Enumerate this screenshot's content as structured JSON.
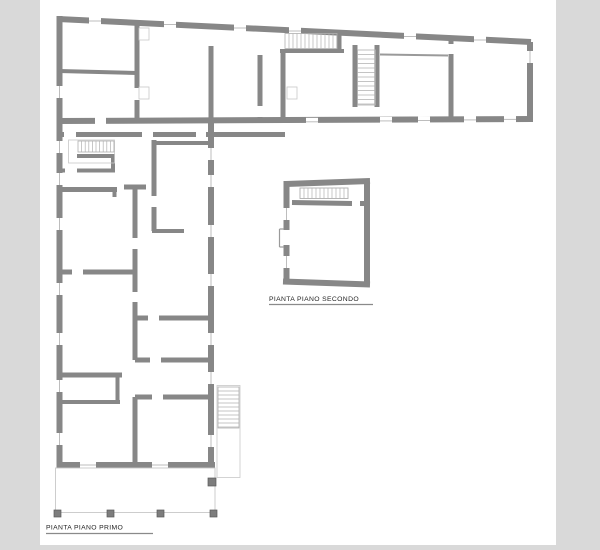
{
  "document": {
    "type": "architectural-floor-plan-sheet",
    "background_color": "#d9d9d9",
    "canvas_color": "#ffffff",
    "canvas": {
      "x": 40,
      "y": 0,
      "width": 516,
      "height": 545
    }
  },
  "colors": {
    "wall": "#878787",
    "thin_wall": "#9a9a9a",
    "window_line": "#bdbdbd",
    "stair_line": "#b0b0b0",
    "outline": "#c8c8c8",
    "pillar_fill": "#7d7d7d",
    "pillar_stroke": "#5a5a5a",
    "underline": "#8a8a8a",
    "text": "#1f1f1f"
  },
  "labels": {
    "floor1": {
      "text": "PIANTA PIANO PRIMO",
      "x": 46,
      "y": 529.5,
      "underline": {
        "x1": 46,
        "y1": 533.5,
        "x2": 153
      }
    },
    "floor2": {
      "text": "PIANTA PIANO SECONDO",
      "x": 269,
      "y": 301,
      "underline": {
        "x1": 269,
        "y1": 304.5,
        "x2": 373
      }
    }
  },
  "floorplan": {
    "walls": [
      [
        58,
        19,
        531,
        42,
        6
      ],
      [
        59.5,
        16,
        59.5,
        468,
        6
      ],
      [
        530,
        42,
        530,
        122,
        6
      ],
      [
        57,
        121,
        531,
        119,
        6
      ],
      [
        57,
        134.5,
        285,
        134.5,
        5
      ],
      [
        211,
        122,
        211,
        468,
        6
      ],
      [
        57,
        465,
        215,
        465,
        6
      ],
      [
        211,
        46,
        211,
        122,
        5
      ],
      [
        137,
        21,
        137,
        118,
        5
      ],
      [
        59,
        71,
        137,
        73,
        4
      ],
      [
        260,
        55,
        260,
        118,
        5
      ],
      [
        280,
        51,
        344,
        51,
        4
      ],
      [
        339,
        30,
        339,
        51,
        5
      ],
      [
        283,
        50,
        283,
        121,
        5
      ],
      [
        355,
        45,
        355,
        107,
        5
      ],
      [
        377,
        45,
        377,
        107,
        5
      ],
      [
        451,
        40,
        451,
        119,
        5
      ],
      [
        77,
        156,
        115,
        156,
        4
      ],
      [
        113,
        156,
        113,
        172,
        4
      ],
      [
        77,
        170.5,
        115,
        170.5,
        4
      ],
      [
        57,
        170.5,
        65,
        170.5,
        4
      ],
      [
        59,
        189.5,
        117,
        189.5,
        5
      ],
      [
        114.5,
        189,
        114.5,
        197,
        4
      ],
      [
        154,
        140,
        154,
        231,
        5
      ],
      [
        154,
        143,
        209,
        143,
        4
      ],
      [
        152,
        231,
        184,
        231,
        4
      ],
      [
        124,
        187,
        146,
        187,
        5
      ],
      [
        135,
        187,
        135,
        360,
        5
      ],
      [
        135,
        397,
        135,
        465,
        5
      ],
      [
        60,
        272,
        135,
        272,
        5
      ],
      [
        133,
        318,
        213,
        318,
        5
      ],
      [
        135,
        360,
        212,
        360,
        5
      ],
      [
        58,
        375,
        122,
        375,
        5
      ],
      [
        60,
        402,
        120,
        402,
        4
      ],
      [
        117.5,
        377,
        117.5,
        402,
        4
      ],
      [
        135,
        397,
        212,
        397,
        5
      ],
      [
        286,
        184,
        370,
        181,
        6
      ],
      [
        286.5,
        181,
        286.5,
        281,
        6
      ],
      [
        367,
        181,
        367,
        285,
        6
      ],
      [
        283,
        281.5,
        370,
        284.5,
        6
      ],
      [
        292,
        202.5,
        352,
        203.5,
        5
      ],
      [
        360,
        203.5,
        370,
        203.5,
        5
      ]
    ],
    "thin_walls": [
      [
        380,
        54.5,
        448,
        55.5,
        2
      ]
    ],
    "door_openings": [
      [
        133.5,
        88,
        7,
        12
      ],
      [
        256.5,
        106,
        7,
        11
      ],
      [
        447.5,
        44,
        7,
        10
      ],
      [
        95,
        117,
        11,
        7
      ],
      [
        64,
        131,
        12,
        7
      ],
      [
        142,
        131,
        11,
        7
      ],
      [
        196,
        131,
        10,
        7
      ],
      [
        150.5,
        196,
        7,
        11
      ],
      [
        131.5,
        238,
        7,
        11
      ],
      [
        131.5,
        292,
        7,
        10
      ],
      [
        72,
        268.5,
        11,
        7
      ],
      [
        148,
        314.5,
        11,
        7
      ],
      [
        150,
        356.5,
        11,
        7
      ],
      [
        152,
        393.5,
        11,
        7
      ],
      [
        352,
        199.5,
        8,
        8
      ],
      [
        283,
        230,
        7,
        15
      ]
    ],
    "windows": [
      [
        89,
        21,
        101,
        21
      ],
      [
        164,
        24.5,
        176,
        24.5
      ],
      [
        234,
        28,
        246,
        28
      ],
      [
        289,
        31,
        301,
        31
      ],
      [
        404,
        36.5,
        416,
        36.5
      ],
      [
        474,
        40,
        486,
        40
      ],
      [
        306,
        121.8,
        318,
        121.8
      ],
      [
        380,
        120.9,
        392,
        120.9
      ],
      [
        418,
        120.5,
        430,
        120.5
      ],
      [
        464,
        119.9,
        476,
        119.9
      ],
      [
        504,
        119.4,
        516,
        119.4
      ],
      [
        80,
        465,
        96,
        465
      ],
      [
        152,
        465,
        168,
        465
      ],
      [
        59.5,
        86,
        59.5,
        98
      ],
      [
        59.5,
        141,
        59.5,
        153
      ],
      [
        59.5,
        173,
        59.5,
        185
      ],
      [
        59.5,
        218,
        59.5,
        230
      ],
      [
        59.5,
        283,
        59.5,
        295
      ],
      [
        59.5,
        333,
        59.5,
        345
      ],
      [
        59.5,
        380,
        59.5,
        392
      ],
      [
        59.5,
        433,
        59.5,
        445
      ],
      [
        211,
        148,
        211,
        160
      ],
      [
        211,
        175,
        211,
        187
      ],
      [
        211,
        225,
        211,
        237
      ],
      [
        211,
        274,
        211,
        286
      ],
      [
        211,
        333,
        211,
        345
      ],
      [
        211,
        372,
        211,
        384
      ],
      [
        211,
        435,
        211,
        447
      ],
      [
        530,
        51,
        530,
        63
      ],
      [
        286.5,
        208,
        286.5,
        220
      ],
      [
        286.5,
        256,
        286.5,
        268
      ]
    ],
    "stairs": [
      {
        "rect": [
          285,
          33.5,
          52,
          15
        ],
        "dir": "h",
        "step": 4,
        "outline": null
      },
      {
        "rect": [
          357.5,
          50,
          18,
          55
        ],
        "dir": "v",
        "step": 4.5,
        "outline": null
      },
      {
        "rect": [
          78,
          141,
          36,
          11
        ],
        "dir": "h",
        "step": 3.6,
        "outline": [
          68.5,
          140,
          46,
          23
        ]
      },
      {
        "rect": [
          218,
          387,
          21,
          41
        ],
        "dir": "v",
        "step": 4,
        "outline": [
          217,
          385.5,
          23,
          92
        ]
      },
      {
        "rect": [
          300,
          188,
          48,
          10.5
        ],
        "dir": "h",
        "step": 4,
        "outline": [
          300,
          188,
          48,
          10.5
        ]
      }
    ],
    "porch_outlines": [
      [
        55.5,
        468,
        159.5,
        44.5
      ]
    ],
    "pillars": [
      [
        54,
        510,
        7
      ],
      [
        107,
        510,
        7
      ],
      [
        157,
        510,
        7
      ],
      [
        210,
        510,
        7
      ],
      [
        208,
        478,
        8
      ]
    ],
    "detail_rects": [
      [
        139,
        28,
        10,
        12
      ],
      [
        139,
        87,
        10,
        12
      ],
      [
        287,
        87,
        10,
        12
      ]
    ],
    "detail_lines": [
      [
        279.5,
        229,
        279.5,
        247
      ],
      [
        279.5,
        229,
        284,
        229
      ],
      [
        279.5,
        247,
        284,
        247
      ]
    ]
  }
}
